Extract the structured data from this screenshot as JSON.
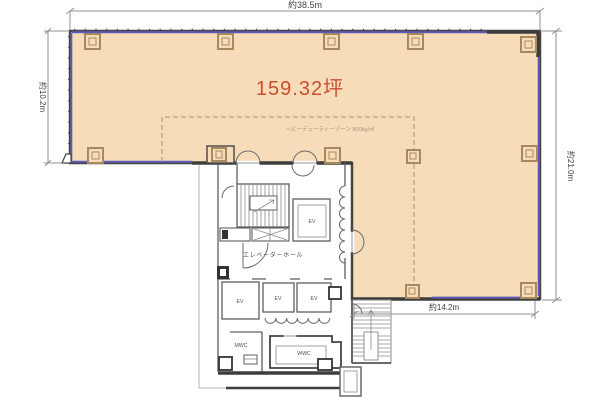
{
  "plan": {
    "area_label": "159.32坪",
    "zone_label": "ヘビーデューティーゾーン 800kg/㎡"
  },
  "dimensions": {
    "top": "約38.5m",
    "left": "約10.2m",
    "right": "約21.0m",
    "bottom_right": "約14.2m"
  },
  "rooms": {
    "elevator_hall": "エレベーターホール",
    "elevator": "EV",
    "mens_wc": "MWC",
    "womens_wc": "WWC"
  },
  "colors": {
    "floor-fill": "#f7dcba",
    "wall": "#454545",
    "window": "#5c5cb8",
    "accent": "#c84e2e",
    "column": "#a8885c",
    "zone-line": "#a39476",
    "dim-line": "#909090",
    "dim-text": "#3f3f3f",
    "room-text": "#4f4f4f"
  }
}
